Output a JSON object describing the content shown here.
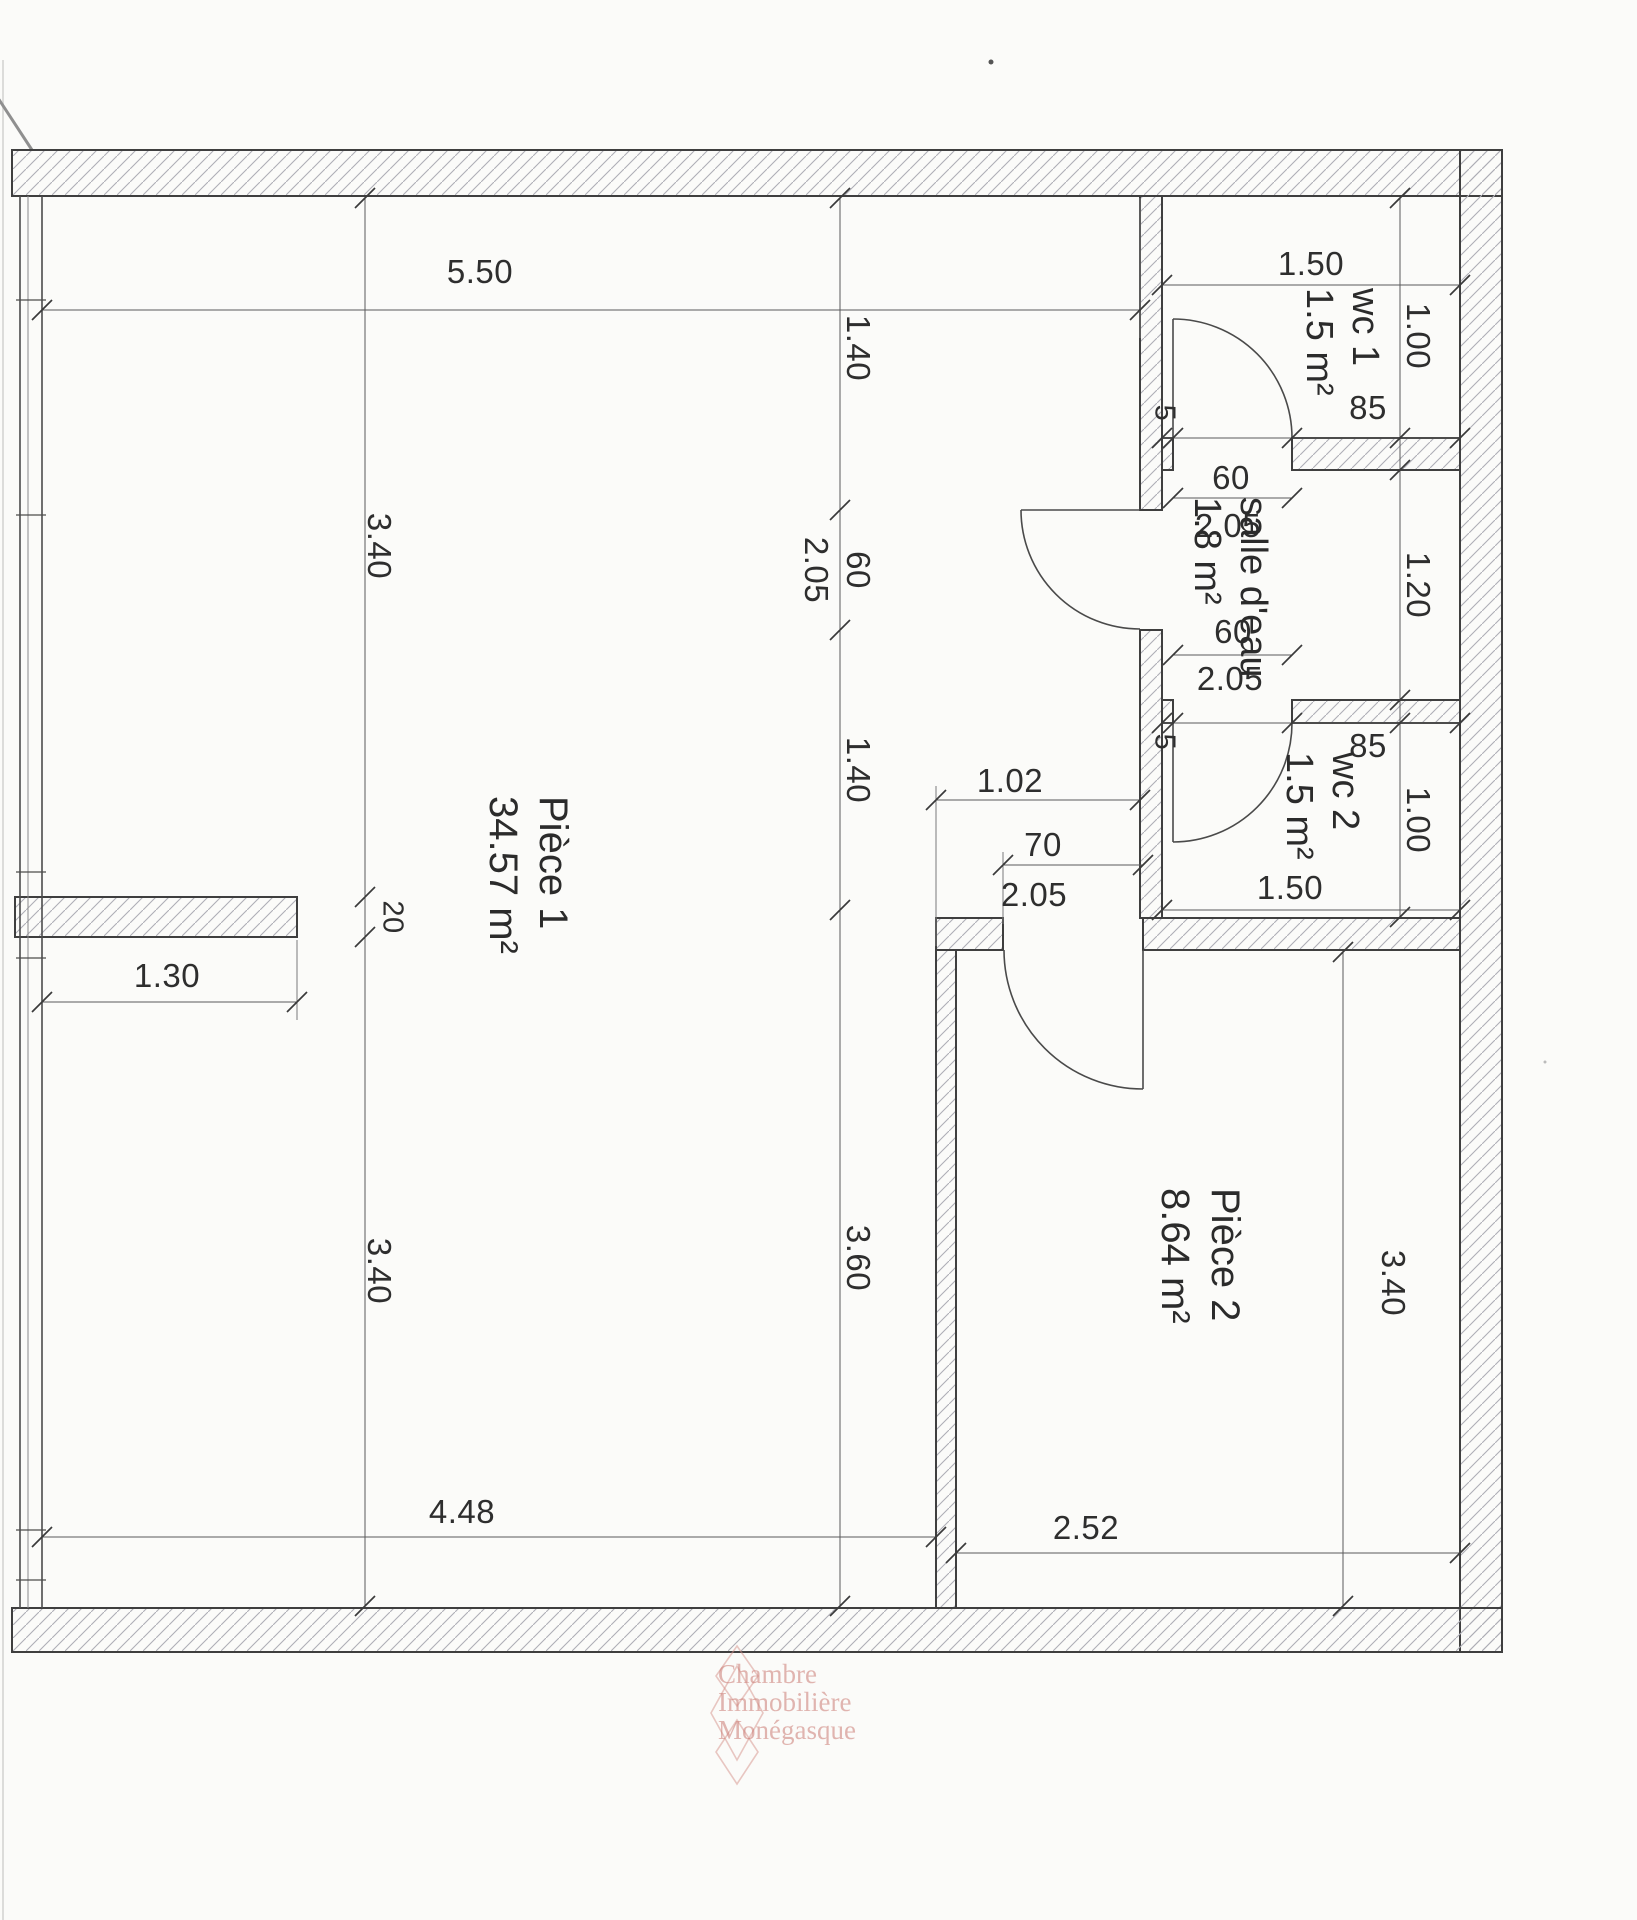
{
  "rooms": {
    "piece1": {
      "name": "Pièce 1",
      "area": "34.57 m²"
    },
    "piece2": {
      "name": "Pièce 2",
      "area": "8.64 m²"
    },
    "wc1": {
      "name": "wc 1",
      "area": "1.5 m²"
    },
    "salle_deau": {
      "name": "salle d'eau",
      "area": "1.8 m²"
    },
    "wc2": {
      "name": "wc 2",
      "area": "1.5 m²"
    }
  },
  "dimensions": {
    "top_width": "5.50",
    "wc1_width": "1.50",
    "wc1_height": "1.00",
    "wc1_wall_offset": "5",
    "wc1_door_to_wall": "85",
    "wc1_door_width": "60",
    "wc1_door_height": "2.05",
    "salle_deau_height": "1.20",
    "wc2_door_width": "60",
    "wc2_door_height": "2.05",
    "wc2_wall_offset": "5",
    "wc2_door_to_wall": "85",
    "wc2_height": "1.00",
    "wc2_width": "1.50",
    "left_upper_height": "3.40",
    "stub_thickness": "20",
    "stub_length": "1.30",
    "left_lower_height": "3.40",
    "mid_upper": "1.40",
    "salle_deau_door_width": "60",
    "salle_deau_door_height": "2.05",
    "mid_lower": "1.40",
    "mid_bottom": "3.60",
    "passage_width": "1.02",
    "piece2_door_width": "70",
    "piece2_door_height": "2.05",
    "piece1_bottom_width": "4.48",
    "piece2_width": "2.52",
    "piece2_height": "3.40"
  },
  "watermark": {
    "line1": "Chambre",
    "line2": "Immobilière",
    "line3": "Monégasque"
  }
}
